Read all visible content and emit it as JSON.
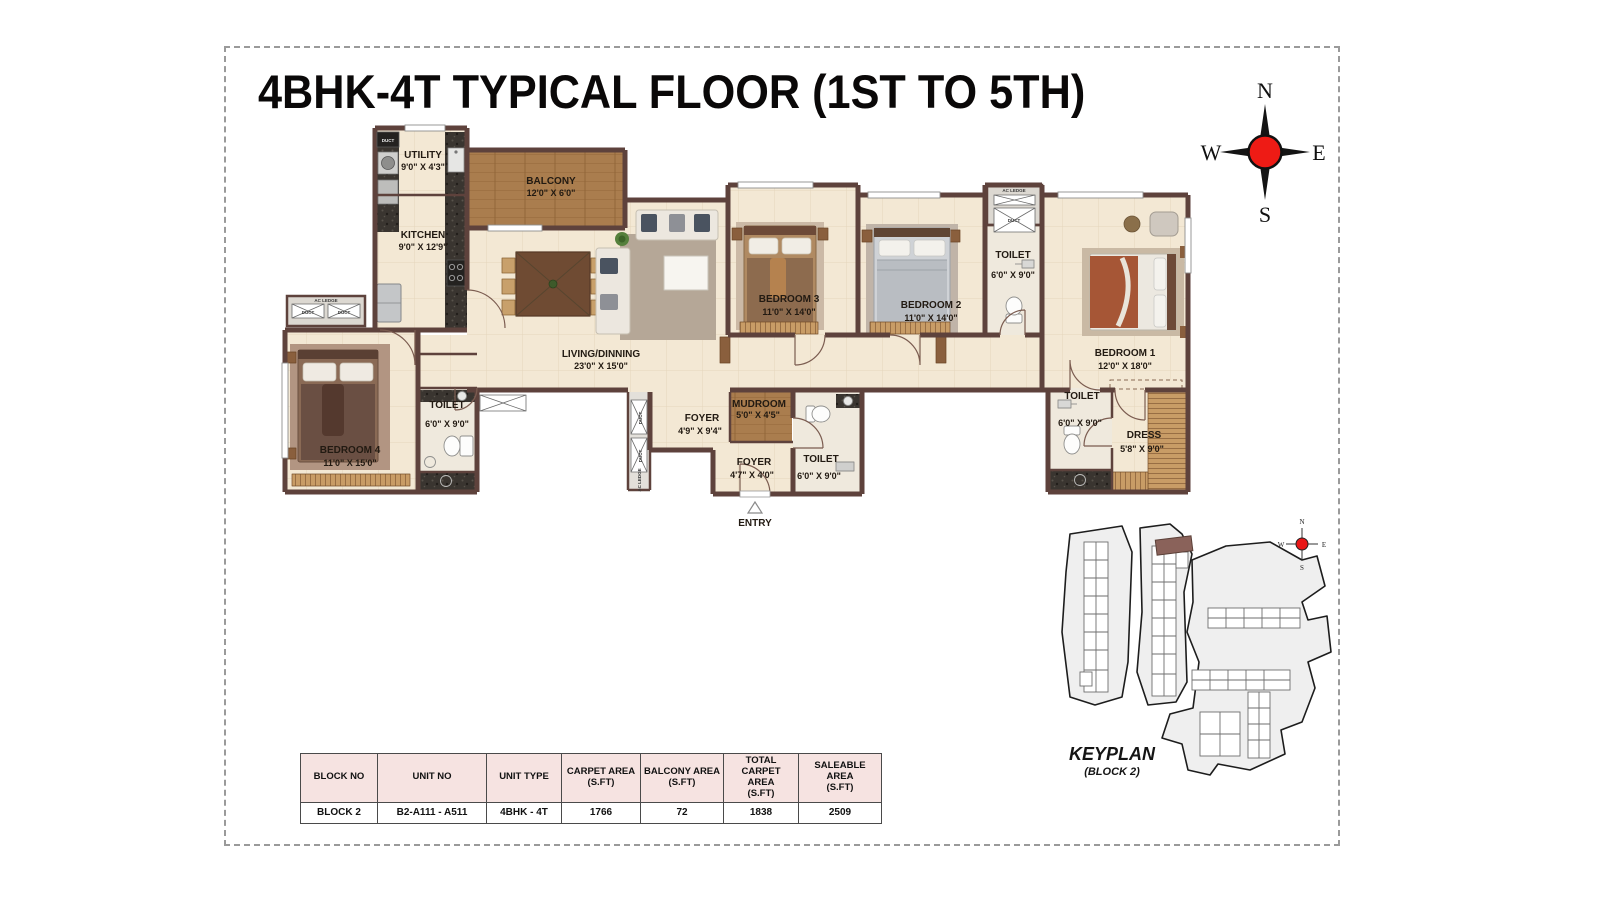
{
  "title": "4BHK-4T TYPICAL FLOOR (1ST TO 5TH)",
  "compass": {
    "n": "N",
    "e": "E",
    "s": "S",
    "w": "W"
  },
  "rooms": {
    "utility": {
      "name": "UTILITY",
      "dim": "9'0\" X 4'3\""
    },
    "kitchen": {
      "name": "KITCHEN",
      "dim": "9'0\" X 12'9\""
    },
    "balcony": {
      "name": "BALCONY",
      "dim": "12'0\" X 6'0\""
    },
    "living": {
      "name": "LIVING/DINNING",
      "dim": "23'0\" X 15'0\""
    },
    "bedroom1": {
      "name": "BEDROOM 1",
      "dim": "12'0\" X 18'0\""
    },
    "bedroom2": {
      "name": "BEDROOM 2",
      "dim": "11'0\" X 14'0\""
    },
    "bedroom3": {
      "name": "BEDROOM 3",
      "dim": "11'0\" X 14'0\""
    },
    "bedroom4": {
      "name": "BEDROOM 4",
      "dim": "11'0\" X 15'0\""
    },
    "toilet_top": {
      "name": "TOILET",
      "dim": "6'0\" X 9'0\""
    },
    "toilet_left": {
      "name": "TOILET",
      "dim": "6'0\" X 9'0\""
    },
    "toilet_mid": {
      "name": "TOILET",
      "dim": "6'0\" X 9'0\""
    },
    "toilet_right": {
      "name": "TOILET",
      "dim": "6'0\" X 9'0\""
    },
    "dress": {
      "name": "DRESS",
      "dim": "5'8\" X 9'0\""
    },
    "foyer_main": {
      "name": "FOYER",
      "dim": "4'9\" X 9'4\""
    },
    "foyer_entry": {
      "name": "FOYER",
      "dim": "4'7\" X 4'0\""
    },
    "mudroom": {
      "name": "MUDROOM",
      "dim": "5'0\" X 4'5\""
    }
  },
  "labels": {
    "entry": "ENTRY",
    "ac_ledge": "AC LEDGE",
    "duct": "DUCT"
  },
  "keyplan": {
    "title": "KEYPLAN",
    "subtitle": "(BLOCK 2)"
  },
  "table": {
    "headers": [
      {
        "l1": "BLOCK NO"
      },
      {
        "l1": "UNIT NO"
      },
      {
        "l1": "UNIT TYPE"
      },
      {
        "l1": "CARPET AREA",
        "l2": "(S.FT)"
      },
      {
        "l1": "BALCONY AREA",
        "l2": "(S.FT)"
      },
      {
        "l1": "TOTAL",
        "l2": "CARPET AREA",
        "l3": "(S.FT)"
      },
      {
        "l1": "SALEABLE AREA",
        "l2": "(S.FT)"
      }
    ],
    "row": {
      "block_no": "BLOCK 2",
      "unit_no": "B2-A111 - A511",
      "unit_type": "4BHK - 4T",
      "carpet_area": "1766",
      "balcony_area": "72",
      "total_carpet_area": "1838",
      "saleable_area": "2509"
    }
  },
  "colors": {
    "wall": "#5e423c",
    "floor_tile": "#f3e8d4",
    "balcony_wood": "#aa7d4e",
    "granite": "#3a3530",
    "compass_red": "#ee1b15",
    "table_header_bg": "#f6e3e1",
    "keyplan_fill": "#efefef",
    "keyplan_highlight": "#8a625a"
  }
}
